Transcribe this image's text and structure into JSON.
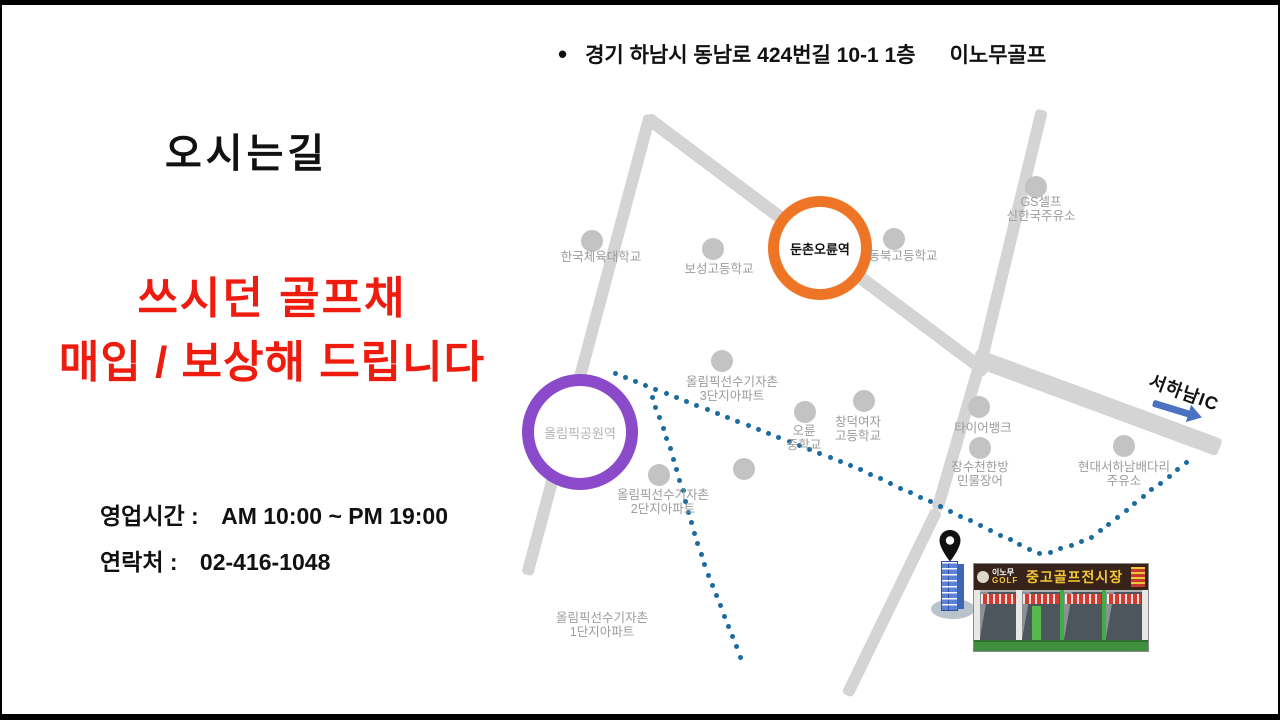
{
  "address_line": {
    "bullet": "•",
    "address": "경기 하남시 동남로 424번길 10-1 1층",
    "store_name": "이노무골프"
  },
  "title": "오시는길",
  "promo": {
    "line1": "쓰시던 골프채",
    "line2": "매입 / 보상해 드립니다",
    "color": "#ee1b0e"
  },
  "info": {
    "hours_label": "영업시간 :",
    "hours_value": "AM 10:00 ~ PM 19:00",
    "contact_label": "연락처 :",
    "contact_value": "02-416-1048"
  },
  "map": {
    "road_color": "#d4d4d4",
    "poi_dot_color": "#c3c3c3",
    "poi_label_color": "#9c9c9c",
    "route_color": "#1b6aa0",
    "roads": [
      {
        "x1": 645,
        "y1": 112,
        "x2": 985,
        "y2": 367,
        "w": 13
      },
      {
        "x1": 648,
        "y1": 110,
        "x2": 525,
        "y2": 570,
        "w": 12
      },
      {
        "x1": 1040,
        "y1": 105,
        "x2": 978,
        "y2": 362,
        "w": 12
      },
      {
        "x1": 978,
        "y1": 358,
        "x2": 935,
        "y2": 505,
        "w": 12
      },
      {
        "x1": 935,
        "y1": 505,
        "x2": 845,
        "y2": 690,
        "w": 12
      },
      {
        "x1": 972,
        "y1": 352,
        "x2": 1218,
        "y2": 443,
        "w": 18
      }
    ],
    "stations": [
      {
        "label": "둔촌오륜역",
        "x": 818,
        "y": 243,
        "r": 41,
        "ring": 11,
        "color": "#ee7426",
        "label_color": "#111111",
        "bold": true
      },
      {
        "label": "올림픽공원역",
        "x": 578,
        "y": 427,
        "r": 46,
        "ring": 12,
        "color": "#8a4ac9",
        "label_color": "#b5b5b5",
        "bold": false
      }
    ],
    "pois": [
      {
        "dot": [
          590,
          236
        ],
        "label_x": 599,
        "label_y": 245,
        "lines": [
          "한국체육대학교"
        ]
      },
      {
        "dot": [
          711,
          244
        ],
        "label_x": 717,
        "label_y": 257,
        "lines": [
          "보성고등학교"
        ]
      },
      {
        "dot": [
          892,
          234
        ],
        "label_x": 901,
        "label_y": 244,
        "lines": [
          "동북고등학교"
        ]
      },
      {
        "dot": [
          1034,
          182
        ],
        "label_x": 1039,
        "label_y": 190,
        "lines": [
          "GS셀프",
          "신한국주유소"
        ]
      },
      {
        "dot": [
          720,
          356
        ],
        "label_x": 730,
        "label_y": 370,
        "lines": [
          "올림픽선수기자촌",
          "3단지아파트"
        ]
      },
      {
        "dot": [
          803,
          407
        ],
        "label_x": 802,
        "label_y": 419,
        "lines": [
          "오륜",
          "중학교"
        ]
      },
      {
        "dot": [
          862,
          396
        ],
        "label_x": 856,
        "label_y": 410,
        "lines": [
          "창덕여자",
          "고등학교"
        ]
      },
      {
        "dot": [
          977,
          402
        ],
        "label_x": 981,
        "label_y": 416,
        "lines": [
          "타이어뱅크"
        ]
      },
      {
        "dot": [
          978,
          443
        ],
        "label_x": 978,
        "label_y": 455,
        "lines": [
          "장수천한방",
          "민물장어"
        ]
      },
      {
        "dot": [
          1122,
          441
        ],
        "label_x": 1122,
        "label_y": 455,
        "lines": [
          "현대서하남배다리",
          "주유소"
        ]
      },
      {
        "dot": [
          657,
          470
        ],
        "label_x": 661,
        "label_y": 483,
        "lines": [
          "올림픽선수기자촌",
          "2단지아파트"
        ]
      },
      {
        "dot": null,
        "label_x": 600,
        "label_y": 606,
        "lines": [
          "올림픽선수기자촌",
          "1단지아파트"
        ]
      },
      {
        "dot": [
          742,
          464
        ],
        "label_x": null,
        "label_y": null,
        "lines": []
      }
    ],
    "routes": [
      {
        "name": "route-main",
        "spacing": 11,
        "points": [
          [
            613,
            368
          ],
          [
            860,
            465
          ],
          [
            935,
            500
          ],
          [
            1040,
            550
          ],
          [
            1088,
            534
          ],
          [
            1190,
            453
          ]
        ]
      },
      {
        "name": "route-branch",
        "spacing": 11,
        "points": [
          [
            650,
            392
          ],
          [
            666,
            437
          ],
          [
            680,
            482
          ],
          [
            692,
            527
          ],
          [
            704,
            565
          ],
          [
            718,
            600
          ],
          [
            733,
            638
          ],
          [
            741,
            658
          ]
        ]
      }
    ],
    "ic": {
      "label": "서하남IC",
      "arrow_color": "#4a72c0"
    },
    "store_photo": {
      "sign_brand_top": "이노무",
      "sign_brand_bottom": "GOLF",
      "sign_main": "중고골프전시장"
    }
  }
}
